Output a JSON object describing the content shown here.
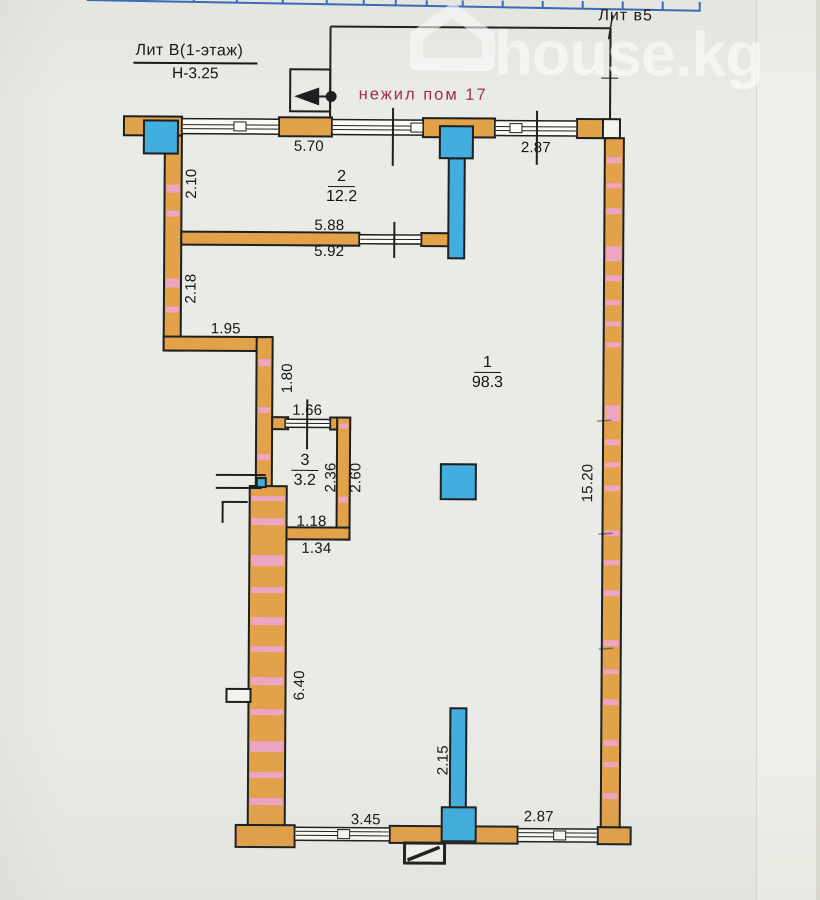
{
  "page": {
    "brand": "house.kg",
    "watermark_icon": "house-icon"
  },
  "titles": {
    "building": "Лит В(1-этаж)",
    "height": "Н-3.25",
    "annex": "Лит в5",
    "premise": "нежил пом 17"
  },
  "rooms": {
    "r1": {
      "num": "1",
      "area": "98.3"
    },
    "r2": {
      "num": "2",
      "area": "12.2"
    },
    "r3": {
      "num": "3",
      "area": "3.2"
    }
  },
  "dims": {
    "top_left_window": "5.70",
    "top_right_window": "2.87",
    "left_upper": "2.10",
    "left_lower": "2.18",
    "jog_width": "1.95",
    "jog_height": "1.80",
    "room3_window": "1.66",
    "room3_inner_h": "2.36",
    "room3_outer_h": "2.60",
    "room3_inner_w": "1.18",
    "room3_outer_w": "1.34",
    "divider_inner": "5.88",
    "divider_outer": "5.92",
    "right_wall": "15.20",
    "left_thick_wall": "6.40",
    "bottom_column": "2.15",
    "bottom_left_window": "3.45",
    "bottom_right_window": "2.87"
  },
  "colors": {
    "paper": "#e9ebe6",
    "paper2": "#f0efe9",
    "wall": "#e2a24a",
    "blue": "#42aede",
    "pink": "#f0a6d6",
    "red": "#a42a52",
    "table": "#3a68ba",
    "line": "#1f1f1f"
  }
}
